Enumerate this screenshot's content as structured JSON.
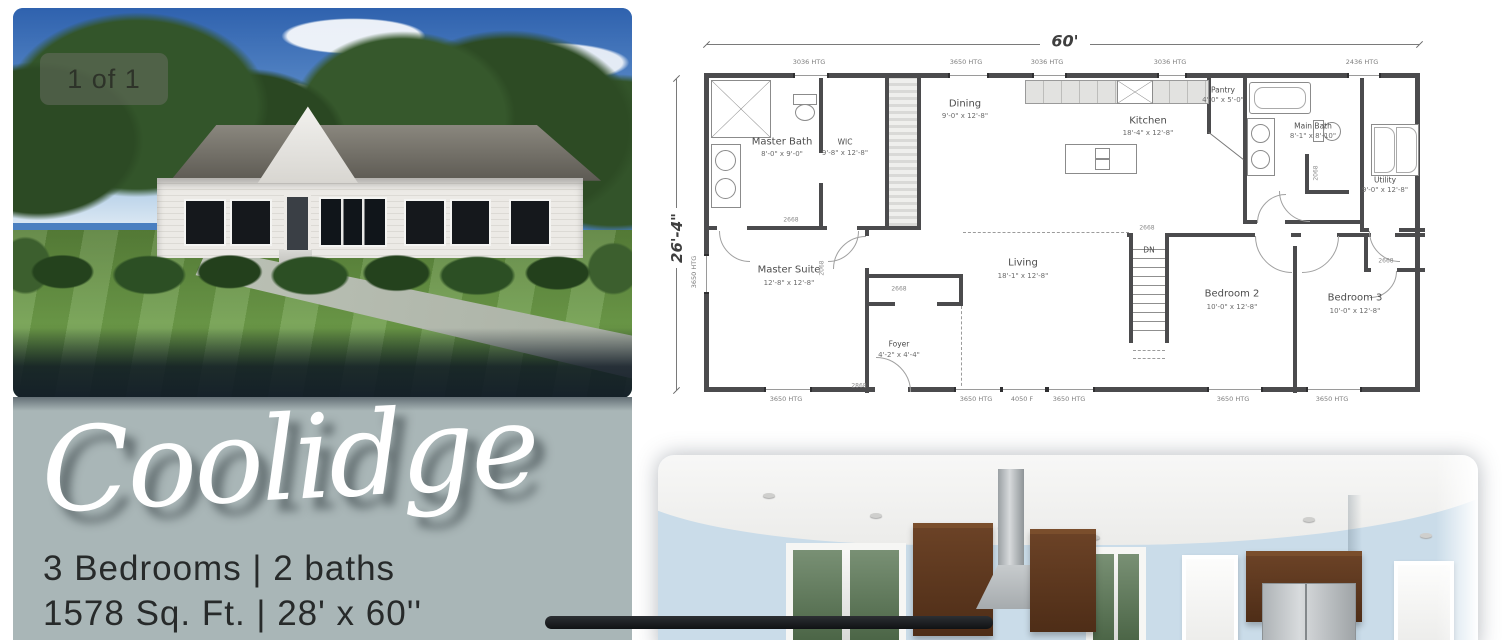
{
  "gallery": {
    "badge": "1 of 1"
  },
  "info_panel": {
    "model_name": "Coolidge",
    "specs_line1": "3 Bedrooms | 2 baths",
    "specs_line2": "1578 Sq. Ft. | 28' x 60''",
    "background_color": "#a9b6b7",
    "text_color": "#272a2a"
  },
  "floor_plan": {
    "overall_width": "60'",
    "overall_depth": "26'-4\"",
    "stairs_label": "DN",
    "rooms": [
      {
        "name": "Master Bath",
        "dims": "8'-0\" x 9'-0\""
      },
      {
        "name": "WIC",
        "dims": "9'-8\" x 12'-8\""
      },
      {
        "name": "Dining",
        "dims": "9'-0\" x 12'-8\""
      },
      {
        "name": "Kitchen",
        "dims": "18'-4\" x 12'-8\""
      },
      {
        "name": "Pantry",
        "dims": "4'-0\" x 5'-0\""
      },
      {
        "name": "Main Bath",
        "dims": "8'-1\" x 8'-10\""
      },
      {
        "name": "Utility",
        "dims": "9'-0\" x 12'-8\""
      },
      {
        "name": "Master Suite",
        "dims": "12'-8\" x 12'-8\""
      },
      {
        "name": "Living",
        "dims": "18'-1\" x 12'-8\""
      },
      {
        "name": "Foyer",
        "dims": "4'-2\" x 4'-4\""
      },
      {
        "name": "Bedroom 2",
        "dims": "10'-0\" x 12'-8\""
      },
      {
        "name": "Bedroom 3",
        "dims": "10'-0\" x 12'-8\""
      }
    ],
    "window_labels_top": [
      "3036 HTG",
      "3650 HTG",
      "3036 HTG",
      "3036 HTG",
      "2436 HTG"
    ],
    "window_labels_bottom": [
      "3650 HTG",
      "3650 HTG",
      "4050 F",
      "3650 HTG",
      "3650 HTG",
      "3650 HTG"
    ],
    "window_label_left": "3650 HTG",
    "door_labels": [
      "2668",
      "2068",
      "2868",
      "2668",
      "2668",
      "2068",
      "2668"
    ]
  },
  "colors": {
    "panel_sage": "#a9b6b7",
    "divider_bar": "#1a1d20",
    "plan_walls": "#4b4b4d",
    "kitchen_cabinets": "#5a3620",
    "kitchen_walls": "#cadce9"
  }
}
